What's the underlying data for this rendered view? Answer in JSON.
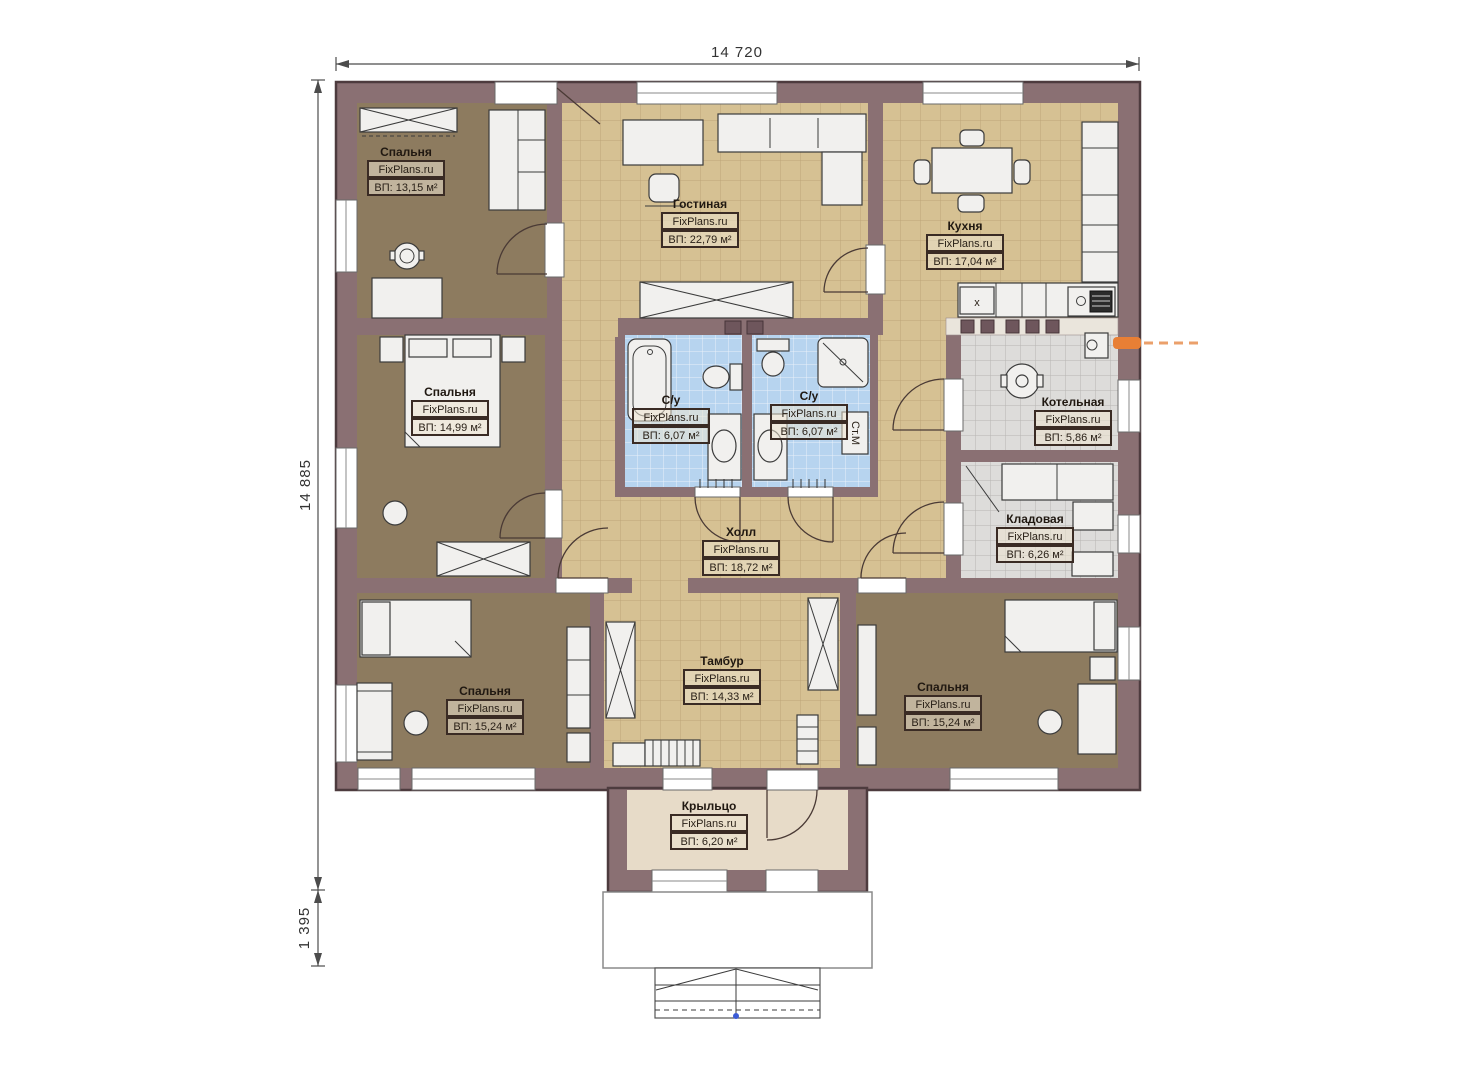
{
  "brand": "FixPlans.ru",
  "dimensions": {
    "width_top": "14 720",
    "height_left": "14 885",
    "porch_depth": "1 395"
  },
  "rooms": [
    {
      "id": "bedroom-1",
      "name": "Спальня",
      "brand": "FixPlans.ru",
      "area": "ВП: 13,15 м²"
    },
    {
      "id": "living-room",
      "name": "Гостиная",
      "brand": "FixPlans.ru",
      "area": "ВП: 22,79 м²"
    },
    {
      "id": "kitchen",
      "name": "Кухня",
      "brand": "FixPlans.ru",
      "area": "ВП: 17,04 м²"
    },
    {
      "id": "bedroom-2",
      "name": "Спальня",
      "brand": "FixPlans.ru",
      "area": "ВП: 14,99 м²"
    },
    {
      "id": "bathroom-left",
      "name": "С/у",
      "brand": "FixPlans.ru",
      "area": "ВП: 6,07 м²"
    },
    {
      "id": "bathroom-right",
      "name": "С/у",
      "brand": "FixPlans.ru",
      "area": "ВП: 6,07 м²"
    },
    {
      "id": "boiler-room",
      "name": "Котельная",
      "brand": "FixPlans.ru",
      "area": "ВП: 5,86 м²"
    },
    {
      "id": "storage",
      "name": "Кладовая",
      "brand": "FixPlans.ru",
      "area": "ВП: 6,26 м²"
    },
    {
      "id": "hall",
      "name": "Холл",
      "brand": "FixPlans.ru",
      "area": "ВП: 18,72 м²"
    },
    {
      "id": "bedroom-3",
      "name": "Спальня",
      "brand": "FixPlans.ru",
      "area": "ВП: 15,24 м²"
    },
    {
      "id": "vestibule",
      "name": "Тамбур",
      "brand": "FixPlans.ru",
      "area": "ВП: 14,33 м²"
    },
    {
      "id": "bedroom-4",
      "name": "Спальня",
      "brand": "FixPlans.ru",
      "area": "ВП: 15,24 м²"
    },
    {
      "id": "porch",
      "name": "Крыльцо",
      "brand": "FixPlans.ru",
      "area": "ВП: 6,20 м²"
    }
  ],
  "annotations": {
    "washing_machine": "Ст.М",
    "stove_mark": "x"
  },
  "colors": {
    "wall": "#8a7073",
    "bedroom_floor": "#8d7b5f",
    "tile_tan": "#d6c193",
    "tile_blue": "#b7d4ef",
    "tile_gray": "#dddcda",
    "porch_floor": "#e7dbc8",
    "gas_line": "#e87f35"
  }
}
